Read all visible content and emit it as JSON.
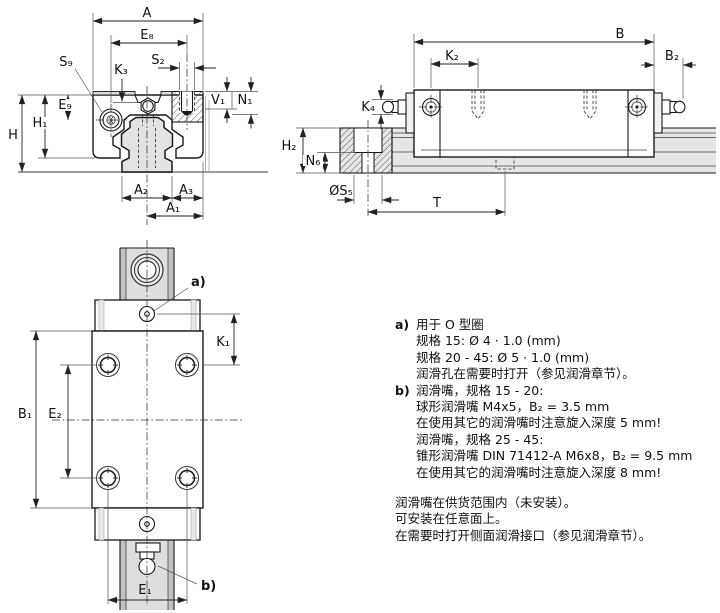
{
  "page": {
    "background": "#ffffff",
    "line_color": "#1a1a1a",
    "fill_gray": "#e3e3e3",
    "description": "Dimensional drawing of a linear guide runner block on a rail, three views plus lubrication notes"
  },
  "dims": {
    "front": {
      "A": "A",
      "E8": "E₈",
      "S2": "S₂",
      "S9": "S₉",
      "K3": "K₃",
      "V1": "V₁",
      "N1": "N₁",
      "E9": "E₉",
      "H": "H",
      "H1": "H₁",
      "A2": "A₂",
      "A3": "A₃",
      "A1": "A₁"
    },
    "side": {
      "B": "B",
      "K2": "K₂",
      "B2": "B₂",
      "K4": "K₄",
      "H2": "H₂",
      "N6": "N₆",
      "S5": "ØS₅",
      "T": "T"
    },
    "top": {
      "a": "a)",
      "K1": "K₁",
      "B1": "B₁",
      "E2": "E₂",
      "b": "b)",
      "E1": "E₁"
    }
  },
  "notes": {
    "item_a": {
      "marker": "a)",
      "lines": [
        "用于 O 型圈",
        "规格 15: Ø 4 · 1.0 (mm)",
        "规格 20 - 45: Ø 5 · 1.0 (mm)",
        "润滑孔在需要时打开（参见润滑章节）。"
      ]
    },
    "item_b": {
      "marker": "b)",
      "lines": [
        "润滑嘴，规格 15 - 20:",
        "球形润滑嘴 M4x5，B₂ = 3.5 mm",
        "在使用其它的润滑嘴时注意旋入深度 5 mm!",
        "润滑嘴，规格 25 - 45:",
        "锥形润滑嘴 DIN 71412-A M6x8，B₂ = 9.5 mm",
        "在使用其它的润滑嘴时注意旋入深度 8 mm!"
      ]
    },
    "footer_lines": [
      "润滑嘴在供货范围内（未安装）。",
      "可安装在任意面上。",
      "在需要时打开侧面润滑接口（参见润滑章节）。"
    ]
  }
}
